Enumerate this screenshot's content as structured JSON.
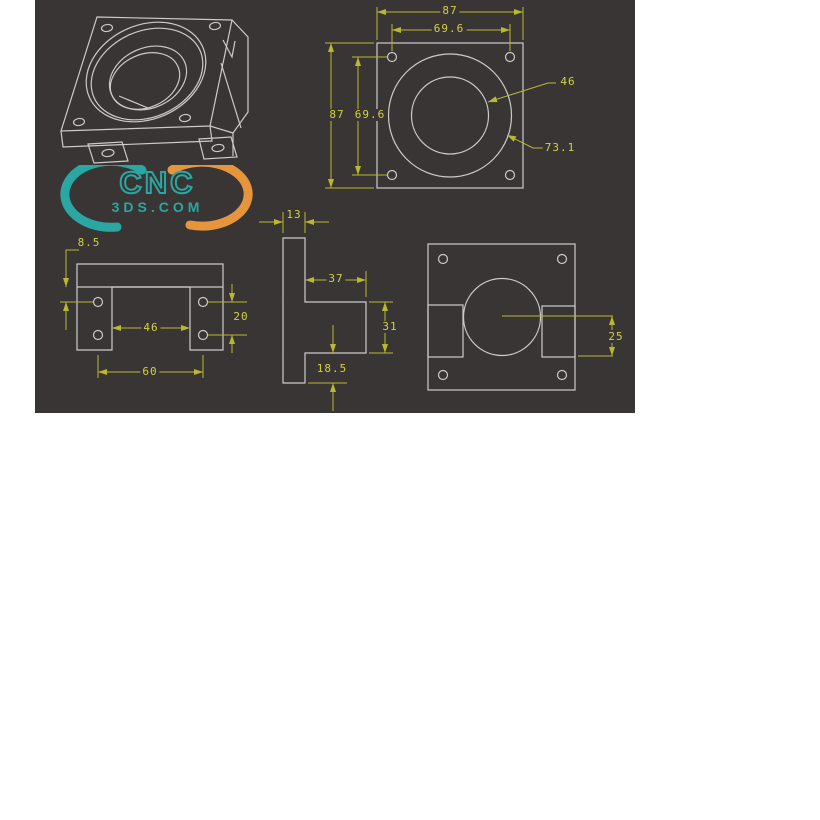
{
  "colors": {
    "background": "#3a3535",
    "geometry_line": "#cbcbcb",
    "dimension_line": "#b9b92f",
    "dimension_text": "#d2d23e",
    "logo_teal": "#2aa7a2",
    "logo_orange": "#e6953c"
  },
  "logo": {
    "brand": "CNC",
    "domain": "3DS.COM"
  },
  "views": {
    "front": {
      "width": "87",
      "hole_span_h": "69.6",
      "height": "87",
      "hole_span_v": "69.6",
      "bore_leader": "46",
      "boss_leader": "73.1"
    },
    "bottom": {
      "flange_offset": "8.5",
      "hole_span_v": "20",
      "slot_width": "46",
      "hole_span_h": "60"
    },
    "side": {
      "wall_thickness": "13",
      "step_depth": "37",
      "step_height": "31",
      "base_offset": "18.5"
    },
    "back": {
      "center_to_notch": "25"
    }
  }
}
